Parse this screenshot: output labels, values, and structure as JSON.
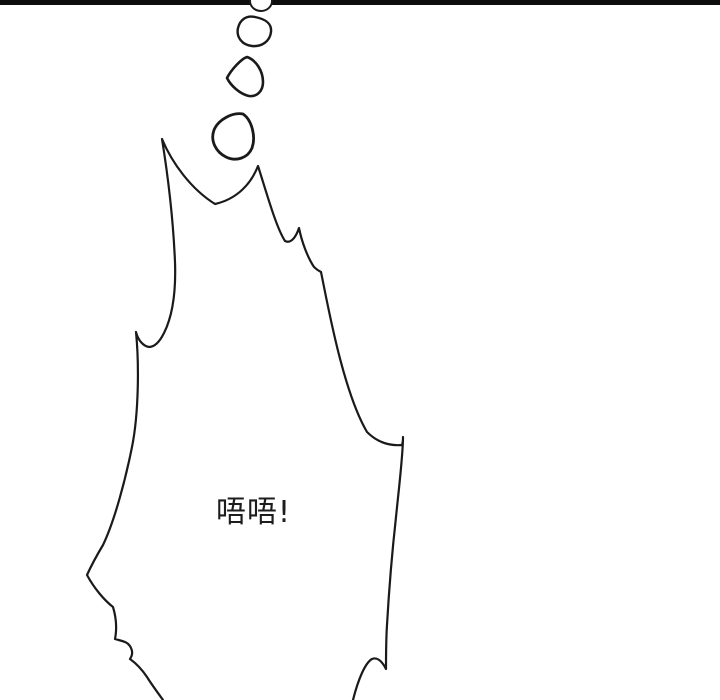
{
  "panel": {
    "bg_color": "#ffffff",
    "ink_color": "#1a1a1a",
    "top_border_color": "#0d0d0d"
  },
  "thought_bubble": {
    "text": "唔唔!",
    "text_color": "#1d1d1d"
  }
}
